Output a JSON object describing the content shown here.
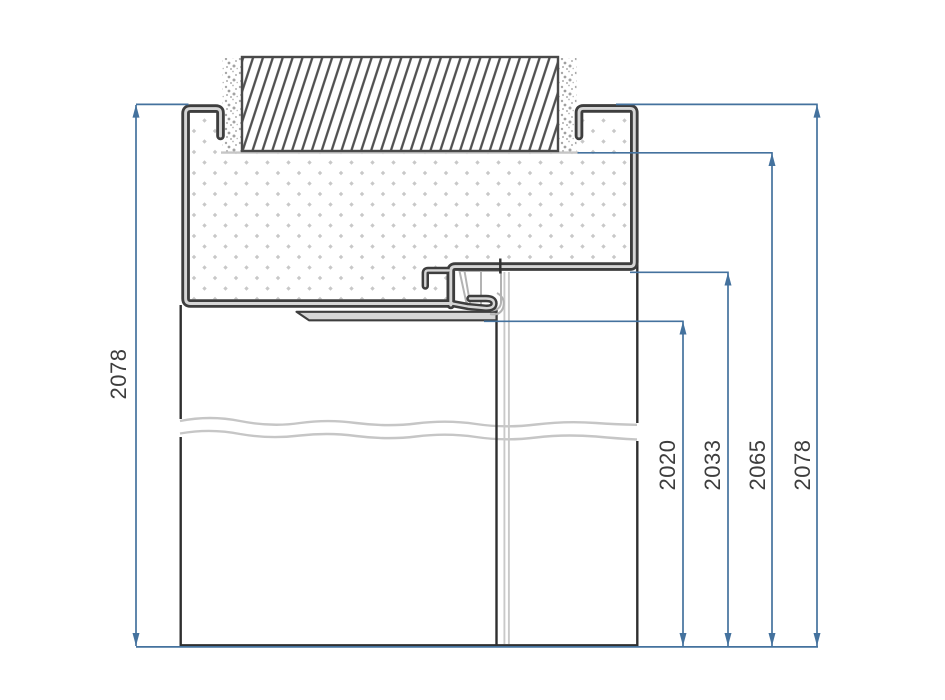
{
  "drawing": {
    "type": "door-frame-head-section-detail",
    "dimensions": {
      "left": {
        "label": "2078"
      },
      "right": [
        {
          "label": "2020"
        },
        {
          "label": "2033"
        },
        {
          "label": "2065"
        },
        {
          "label": "2078"
        }
      ]
    },
    "colors": {
      "dimension_blue": "#44729e",
      "drawing_ink": "#3e3e3e",
      "sheet_core_gray": "#d6d6d6",
      "light_gray": "#c6c6c6",
      "label_gray": "#3d3d3d"
    }
  }
}
